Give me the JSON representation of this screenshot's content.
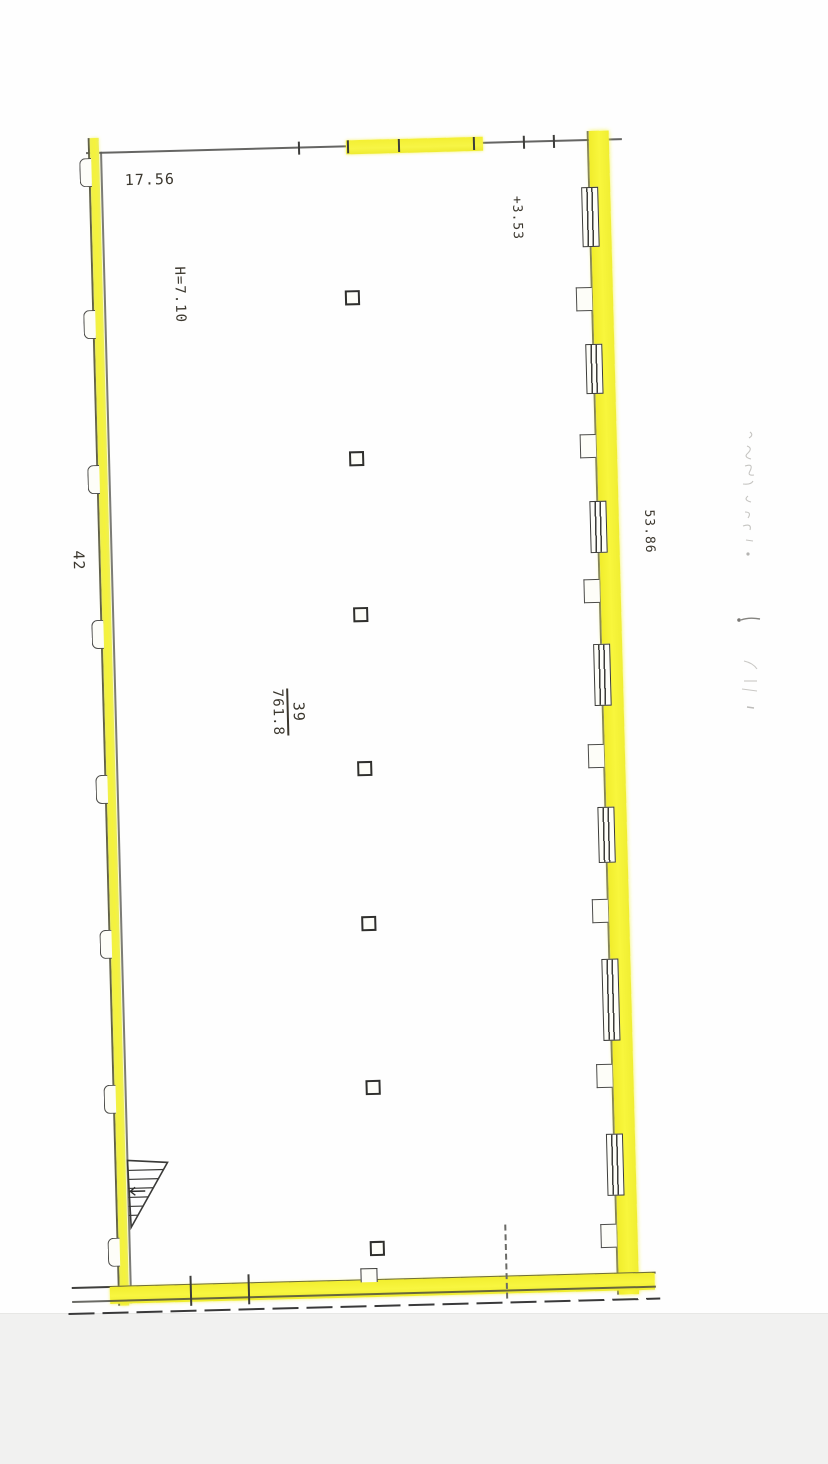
{
  "scan": {
    "paper_color": "#fefefe",
    "scanner_bed_color": "#f1f1f0",
    "highlight_color": "#f5f233",
    "ink_color": "#3b3b3b"
  },
  "plan": {
    "labels": {
      "dim_top": "17.56",
      "height_note": "H=7.10",
      "level_mark": "+3.53",
      "dim_right_wall": "53.86",
      "dim_left_wall": "42",
      "unit_number": "39",
      "unit_area": "761.8"
    },
    "features": {
      "interior_columns": 7,
      "right_wall_windows": 7,
      "left_wall_pilasters": 8,
      "stairs_symbol": "triangular stair flight at bottom-left",
      "margin_note": "faint illegible handwriting in right margin",
      "highlighted_perimeter": "yellow highlighter on outer walls"
    }
  }
}
